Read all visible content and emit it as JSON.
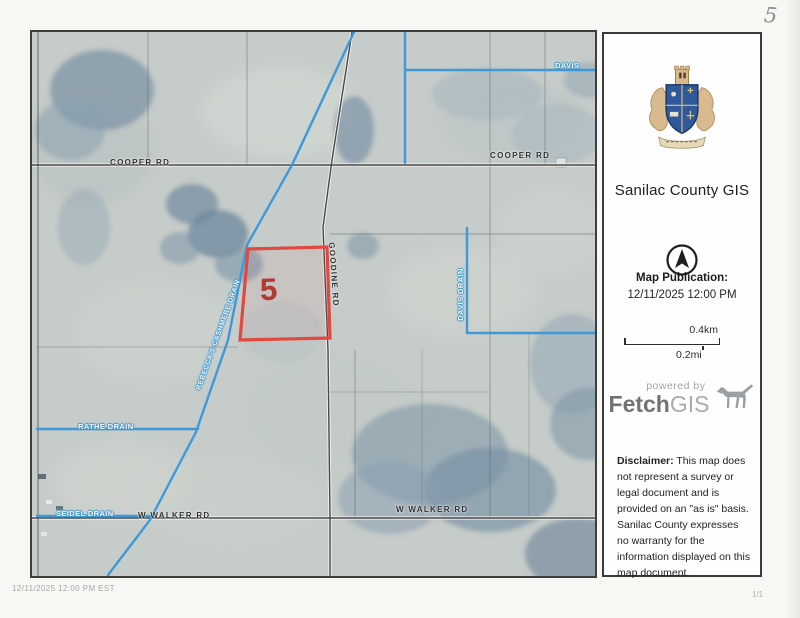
{
  "page": {
    "handwritten_mark": "5",
    "footer_left": "12/11/2025  12:00 PM EST",
    "footer_right": "1/1"
  },
  "sidebar": {
    "title": "Sanilac County GIS",
    "publication_label": "Map Publication:",
    "publication_datetime": "12/11/2025 12:00 PM",
    "scale": {
      "km": "0.4km",
      "mi": "0.2mi"
    },
    "powered_by": "powered by",
    "brand_fetch": "Fetch",
    "brand_gis": "GIS",
    "disclaimer_label": "Disclaimer:",
    "disclaimer_text": " This map does not represent a survey or legal document and is provided on an \"as is\" basis. Sanilac County expresses no warranty for the information displayed on this map document."
  },
  "map": {
    "parcel_label": "5",
    "roads": {
      "cooper_left": "COOPER RD",
      "cooper_right": "COOPER RD",
      "goodine": "GOODINE RD",
      "walker_left": "W WALKER RD",
      "walker_center": "W WALKER RD"
    },
    "drains": {
      "davis_top": "DAVIS",
      "davis_right": "DAVIS DRAIN",
      "diagonal": "REBECCA'S CASHMERE DRAIN",
      "rathe": "RATHE DRAIN",
      "seidel": "SEIDEL DRAIN"
    },
    "colors": {
      "parcel_outline": "#e04840",
      "parcel_number": "#b23b31",
      "drain_blue": "#3f99d8",
      "road_dark": "#46494c",
      "crest_blue": "#30599c"
    }
  }
}
